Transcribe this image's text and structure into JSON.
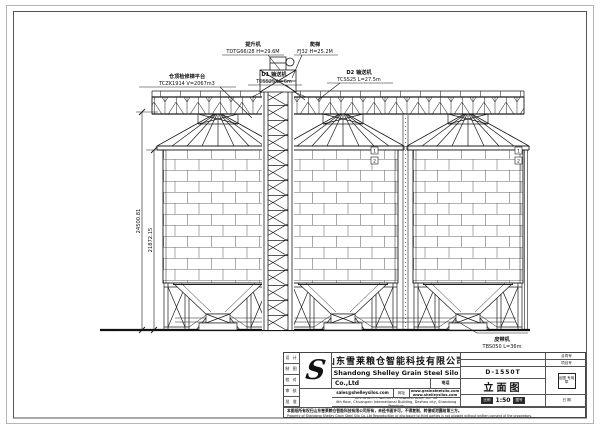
{
  "drawing": {
    "annotations": {
      "platform": {
        "l1": "仓顶检修梯平台",
        "l2": "TCZK1914 V=2067m3"
      },
      "d1_conveyor": {
        "l1": "D1 输送机",
        "l2": "TCSS25 L=6m"
      },
      "elevator": {
        "l1": "提升机",
        "l2": "TDTG66/28 H=29.6M"
      },
      "ladder": {
        "l1": "爬梯",
        "l2": "FJ32 H=25.2M"
      },
      "d2_conveyor": {
        "l1": "D2 输送机",
        "l2": "TCSS25 L=27.5m"
      },
      "belt_conveyor": {
        "l1": "皮带机",
        "l2": "TBS050 L=36m"
      }
    },
    "dimensions": {
      "total_height": "24500.81",
      "silo_height": "21872.15"
    },
    "markers": {
      "m1": "1",
      "m2": "2",
      "m3": "1",
      "m4": "2"
    }
  },
  "titleblock": {
    "company_cn": "山东雪莱粮仓智能科技有限公司",
    "company_en": "Shandong Shelley Grain Steel Silo",
    "company_suffix": "Co.,Ltd",
    "phone_label": "电话",
    "email": "sales@shelleysilos.com",
    "web_label": "网址",
    "website1": "www.grainsteelsilo.com",
    "website2": "www.shelleysilos.com",
    "address_cn": "山东省德州市经济技术开发区创新创业大厦4层",
    "address_en": "4th floor, Chuangxin International Building, Dezhou city, Shandong Province",
    "left_rows": [
      "设 计",
      "制 图",
      "校 对",
      "审 核",
      "批 准"
    ],
    "right_rows": [
      "合同号",
      "项目号",
      "日 期"
    ],
    "stamp": "出图 专用章",
    "project_no": "D-1550T",
    "view_name": "立面图",
    "scale_label": "比例",
    "scale_value": "1:50",
    "sheet_label": "图号",
    "disclaimer_cn": "本图纸所有权归山东雪莱粮仓智能科技有限公司所有，未经书面许可，不得复制、转借或泄露给第三方。",
    "disclaimer_en": "Property of Shandong Shelley Grain Steel Silo Co.,Ltd Reproduction or disclosure to third parties is not allowed without written consent of the proprietors."
  }
}
